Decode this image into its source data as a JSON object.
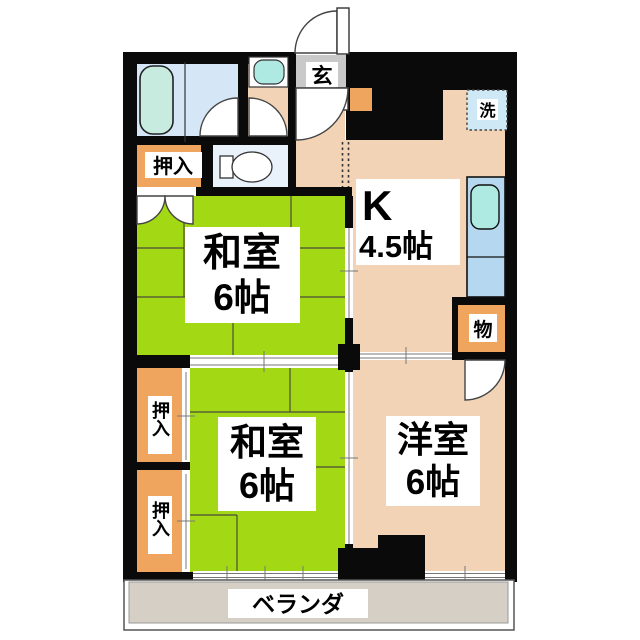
{
  "plan": {
    "rooms": {
      "kitchen": {
        "label": "K",
        "size": "4.5帖"
      },
      "washitsu_upper": {
        "label": "和室",
        "size": "6帖"
      },
      "washitsu_lower": {
        "label": "和室",
        "size": "6帖"
      },
      "yoshitsu": {
        "label": "洋室",
        "size": "6帖"
      }
    },
    "features": {
      "entrance": "玄",
      "washer": "洗",
      "storage": "物",
      "closet_top": "押入",
      "closet_left_upper": "押入",
      "closet_left_lower": "押入",
      "veranda": "ベランダ"
    },
    "colors": {
      "tatami_green": "#a3d914",
      "floor_salmon": "#f2d3b6",
      "closet_orange": "#efa55d",
      "bath_blue": "#d5e7f6",
      "toilet_blue": "#e9f1fa",
      "counter_blue": "#b5d8f0",
      "sink_cyan": "#aee9e2",
      "tub_cyan": "#c7ecdf",
      "washer_blue": "#cfe8f5",
      "genkan_gray": "#c9c9c9",
      "veranda_gray": "#d6cfc5",
      "wall_black": "#0a0a0a"
    }
  }
}
